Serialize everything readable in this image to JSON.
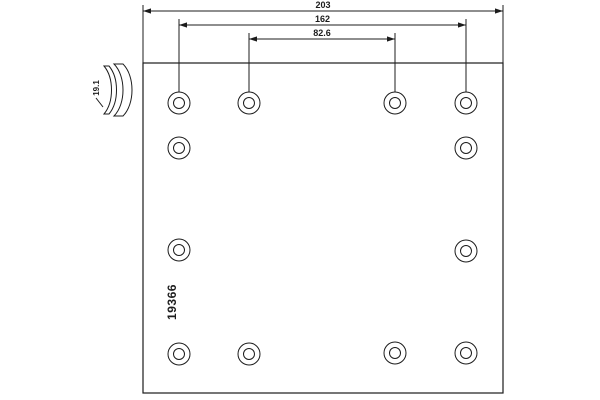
{
  "drawing": {
    "background_color": "#ffffff",
    "line_color": "#1c1c1c",
    "part_number": "19366",
    "profile": {
      "label": "19.1"
    },
    "plate": {
      "x": 143,
      "y": 63,
      "width": 360,
      "height": 330
    },
    "dimensions": [
      {
        "label": "203",
        "x1": 143,
        "x2": 503,
        "y": 11,
        "ext_y1": 5,
        "ext_y2": 63
      },
      {
        "label": "162",
        "x1": 179,
        "x2": 466,
        "y": 25,
        "ext_y1": 19,
        "ext_y2": 93
      },
      {
        "label": "82.6",
        "x1": 249,
        "x2": 395,
        "y": 39,
        "ext_y1": 33,
        "ext_y2": 93
      }
    ],
    "holes": {
      "outer_radius": 11,
      "inner_radius": 5.5,
      "centers": [
        {
          "cx": 179,
          "cy": 103
        },
        {
          "cx": 249,
          "cy": 103
        },
        {
          "cx": 395,
          "cy": 103
        },
        {
          "cx": 466,
          "cy": 103
        },
        {
          "cx": 179,
          "cy": 148
        },
        {
          "cx": 466,
          "cy": 148
        },
        {
          "cx": 179,
          "cy": 250
        },
        {
          "cx": 466,
          "cy": 251
        },
        {
          "cx": 179,
          "cy": 354
        },
        {
          "cx": 249,
          "cy": 354
        },
        {
          "cx": 395,
          "cy": 353
        },
        {
          "cx": 466,
          "cy": 353
        }
      ]
    }
  }
}
